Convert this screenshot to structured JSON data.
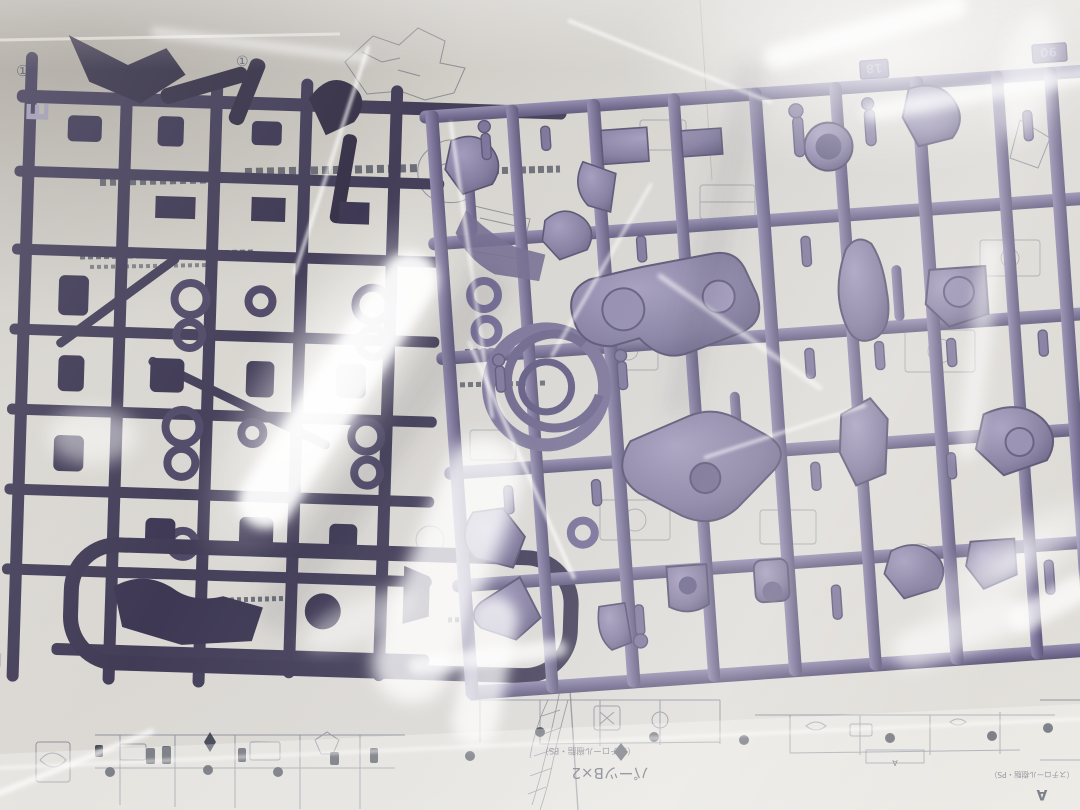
{
  "scene": {
    "description": "Purple plastic model-kit runner (sprue) sealed inside a glossy clear bag, lying on printed assembly instruction sheets",
    "type": "photograph"
  },
  "colors": {
    "paper": "#d7d4ce",
    "paper_bright": "#e8e6e1",
    "print_line": "#5c6275",
    "sprue_purple": "#746c92",
    "sprue_purple_light": "#a79fc0",
    "sprue_purple_dark": "#4e4768",
    "sprue_dark": "#3a3450",
    "glare": "#ffffff"
  },
  "runner": {
    "tag_left": "18",
    "tag_right": "90",
    "letter_top": "E",
    "letter_bottom": "E"
  },
  "sheet": {
    "circled_number": "①",
    "caption_parts": "パーツB×2",
    "caption_material": "（スチロール樹脂・PS）",
    "label_box": "A"
  }
}
